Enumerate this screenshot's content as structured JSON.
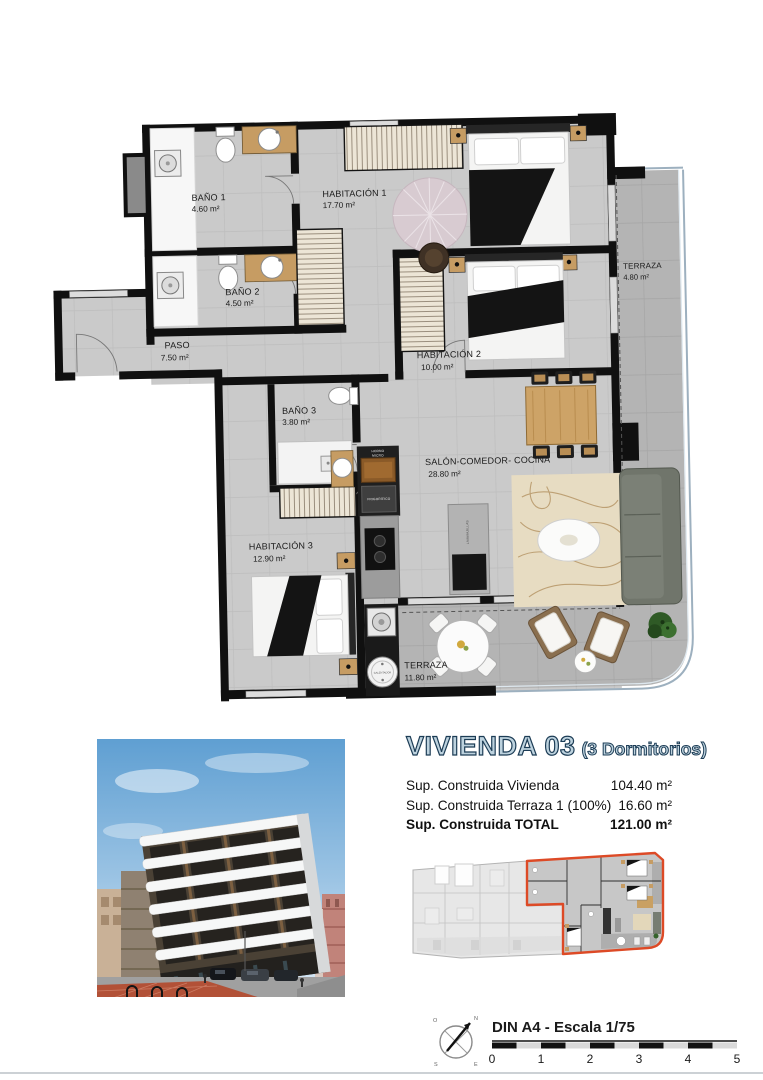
{
  "plan": {
    "rooms": [
      {
        "name": "BAÑO 1",
        "area": "4.60 m²"
      },
      {
        "name": "HABITACIÓN 1",
        "area": "17.70 m²"
      },
      {
        "name": "BAÑO 2",
        "area": "4.50 m²"
      },
      {
        "name": "TERRAZA",
        "area": "4.80 m²"
      },
      {
        "name": "PASO",
        "area": "7.50 m²"
      },
      {
        "name": "HABITACIÓN 2",
        "area": "10.00 m²"
      },
      {
        "name": "BAÑO 3",
        "area": "3.80 m²"
      },
      {
        "name": "SALÓN-COMEDOR- COCINA",
        "area": "28.80 m²"
      },
      {
        "name": "HABITACIÓN 3",
        "area": "12.90 m²"
      },
      {
        "name": "TERRAZA",
        "area": "11.80 m²"
      }
    ],
    "appliances": {
      "oven": "HORNO",
      "micro": "MICRO",
      "fridge": "FRIGORÍFICO",
      "dishwasher": "LAVAVAJILLAS",
      "heater": "CALENTADOR"
    }
  },
  "info": {
    "title": "VIVIENDA 03",
    "subtitle": "(3 Dormitorios)",
    "rows": [
      {
        "label": "Sup. Construida Vivienda",
        "value": "104.40 m²"
      },
      {
        "label": "Sup. Construida Terraza 1 (100%)",
        "value": "16.60 m²"
      },
      {
        "label": "Sup. Construida TOTAL",
        "value": "121.00 m²"
      }
    ]
  },
  "footer": {
    "scale_label": "DIN A4 - Escala 1/75",
    "ticks": [
      "0",
      "1",
      "2",
      "3",
      "4",
      "5"
    ],
    "compass": {
      "n": "N",
      "s": "S",
      "e": "E",
      "w": "O"
    }
  },
  "colors": {
    "highlight": "#dd4a26",
    "title_fill": "#bdd2de",
    "title_stroke": "#1c3c55"
  }
}
